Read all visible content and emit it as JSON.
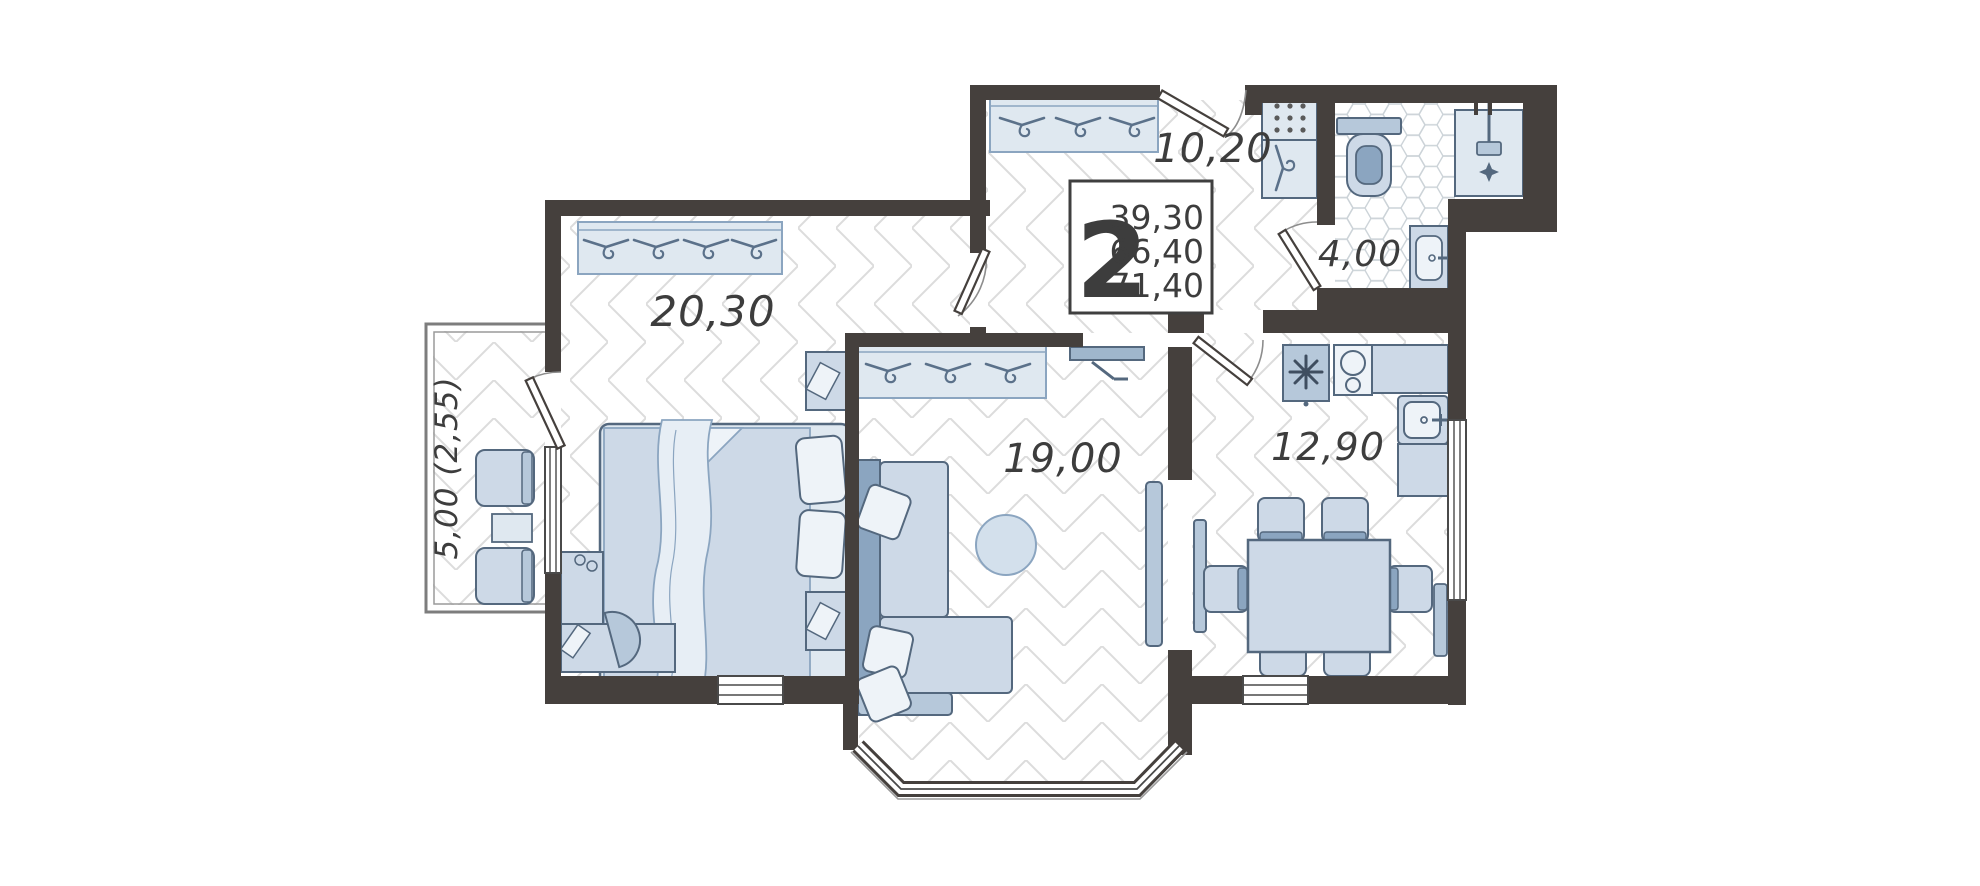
{
  "info_box": {
    "rooms_count": "2",
    "areas": [
      "39,30",
      "66,40",
      "71,40"
    ]
  },
  "rooms": {
    "hallway": {
      "area_label": "10,20"
    },
    "bedroom": {
      "area_label": "20,30"
    },
    "living_room": {
      "area_label": "19,00"
    },
    "kitchen": {
      "area_label": "12,90"
    },
    "bathroom": {
      "area_label": "4,00"
    },
    "balcony": {
      "area_label": "5,00 (2,55)"
    }
  },
  "colors": {
    "wall": "#45403d",
    "furniture_light": "#cdd9e7",
    "furniture_lighter": "#dfe8f0",
    "furniture_mid": "#b6c8da",
    "furniture_accent": "#8ba5c0",
    "furniture_outline": "#54687e",
    "hatch_line": "#dcdcdc",
    "hex_line": "#ccd3d8",
    "label_text": "#3d3d3d"
  }
}
